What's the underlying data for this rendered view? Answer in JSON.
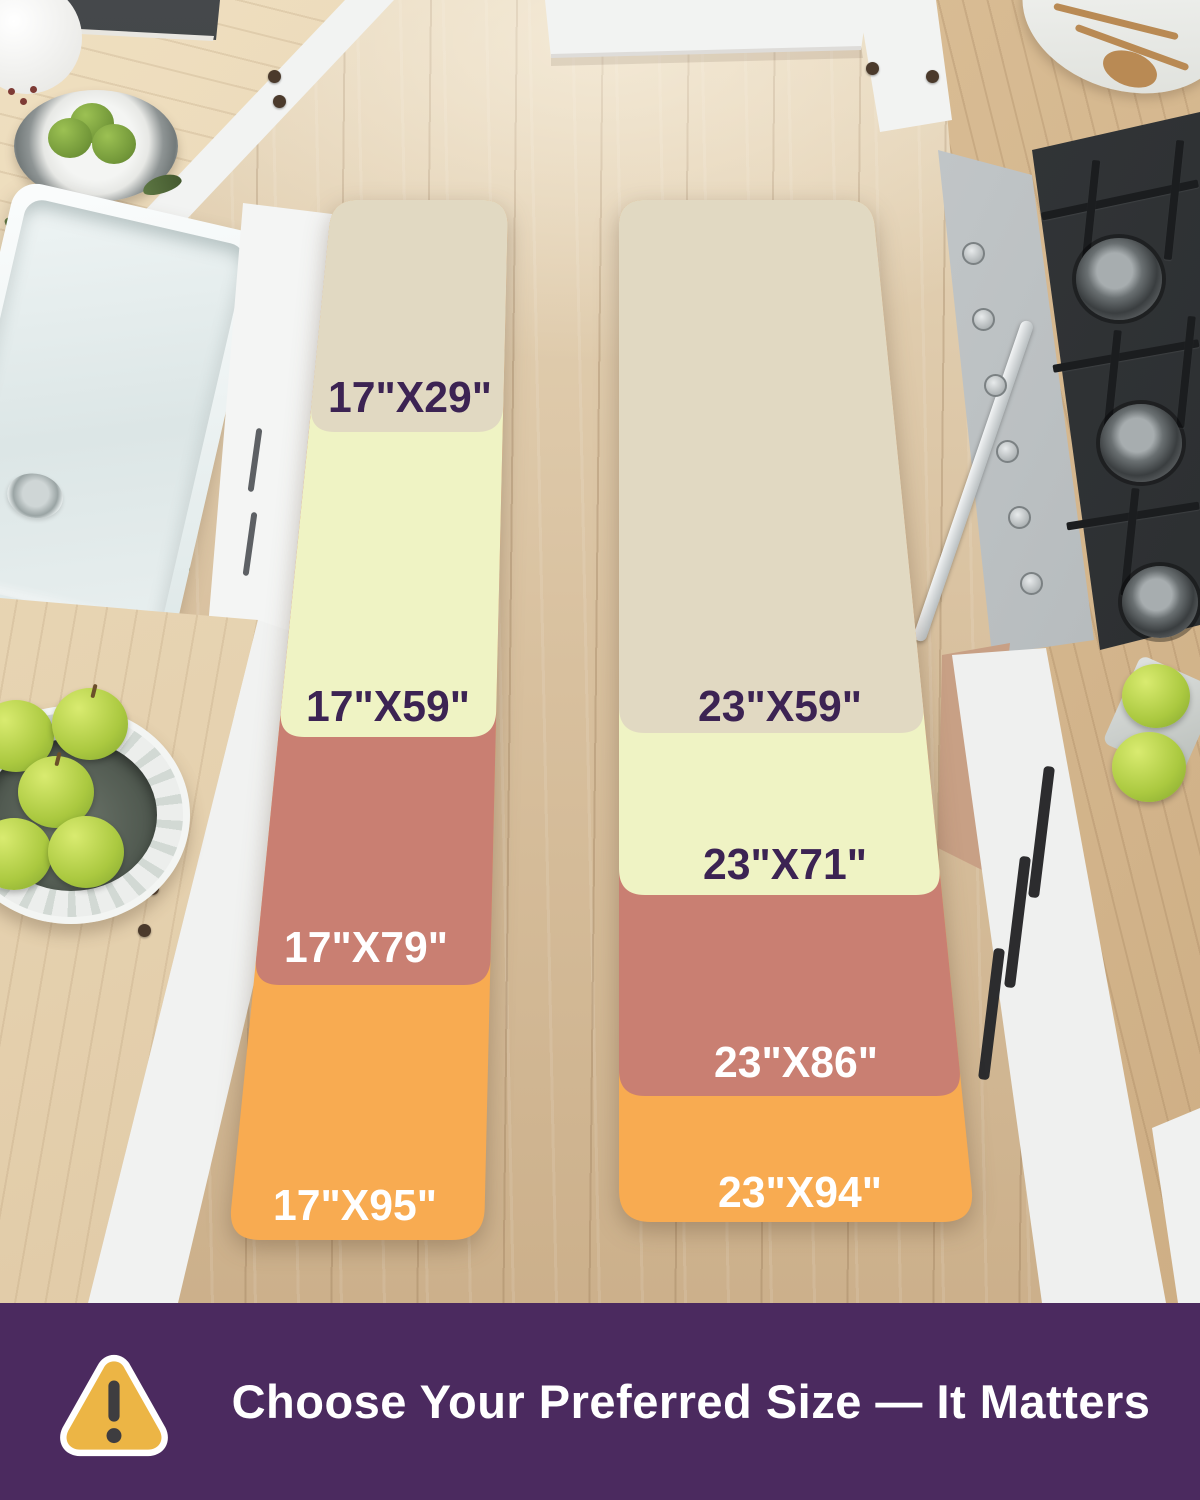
{
  "mats": {
    "columns": [
      {
        "name": "17-inch-runner",
        "sizes": [
          {
            "label": "17\"X29\"",
            "color": "#e1d9c2",
            "text_color": "#3c2353"
          },
          {
            "label": "17\"X59\"",
            "color": "#eff3c4",
            "text_color": "#3c2353"
          },
          {
            "label": "17\"X79\"",
            "color": "#c97f72",
            "text_color": "#ffffff"
          },
          {
            "label": "17\"X95\"",
            "color": "#f8ab51",
            "text_color": "#ffffff"
          }
        ]
      },
      {
        "name": "23-inch-runner",
        "sizes": [
          {
            "label": "23\"X59\"",
            "color": "#e1d9c2",
            "text_color": "#3c2353"
          },
          {
            "label": "23\"X71\"",
            "color": "#eff3c4",
            "text_color": "#3c2353"
          },
          {
            "label": "23\"X86\"",
            "color": "#c97f72",
            "text_color": "#ffffff"
          },
          {
            "label": "23\"X94\"",
            "color": "#f8ab51",
            "text_color": "#ffffff"
          }
        ]
      }
    ]
  },
  "banner": {
    "text": "Choose Your Preferred Size — It Matters",
    "background_color": "#4b2a5f",
    "text_color": "#ffffff",
    "icon": {
      "name": "warning-triangle-icon",
      "fill_color": "#ecb545",
      "border_color": "#ffffff",
      "mark_color": "#3e3d40"
    }
  }
}
